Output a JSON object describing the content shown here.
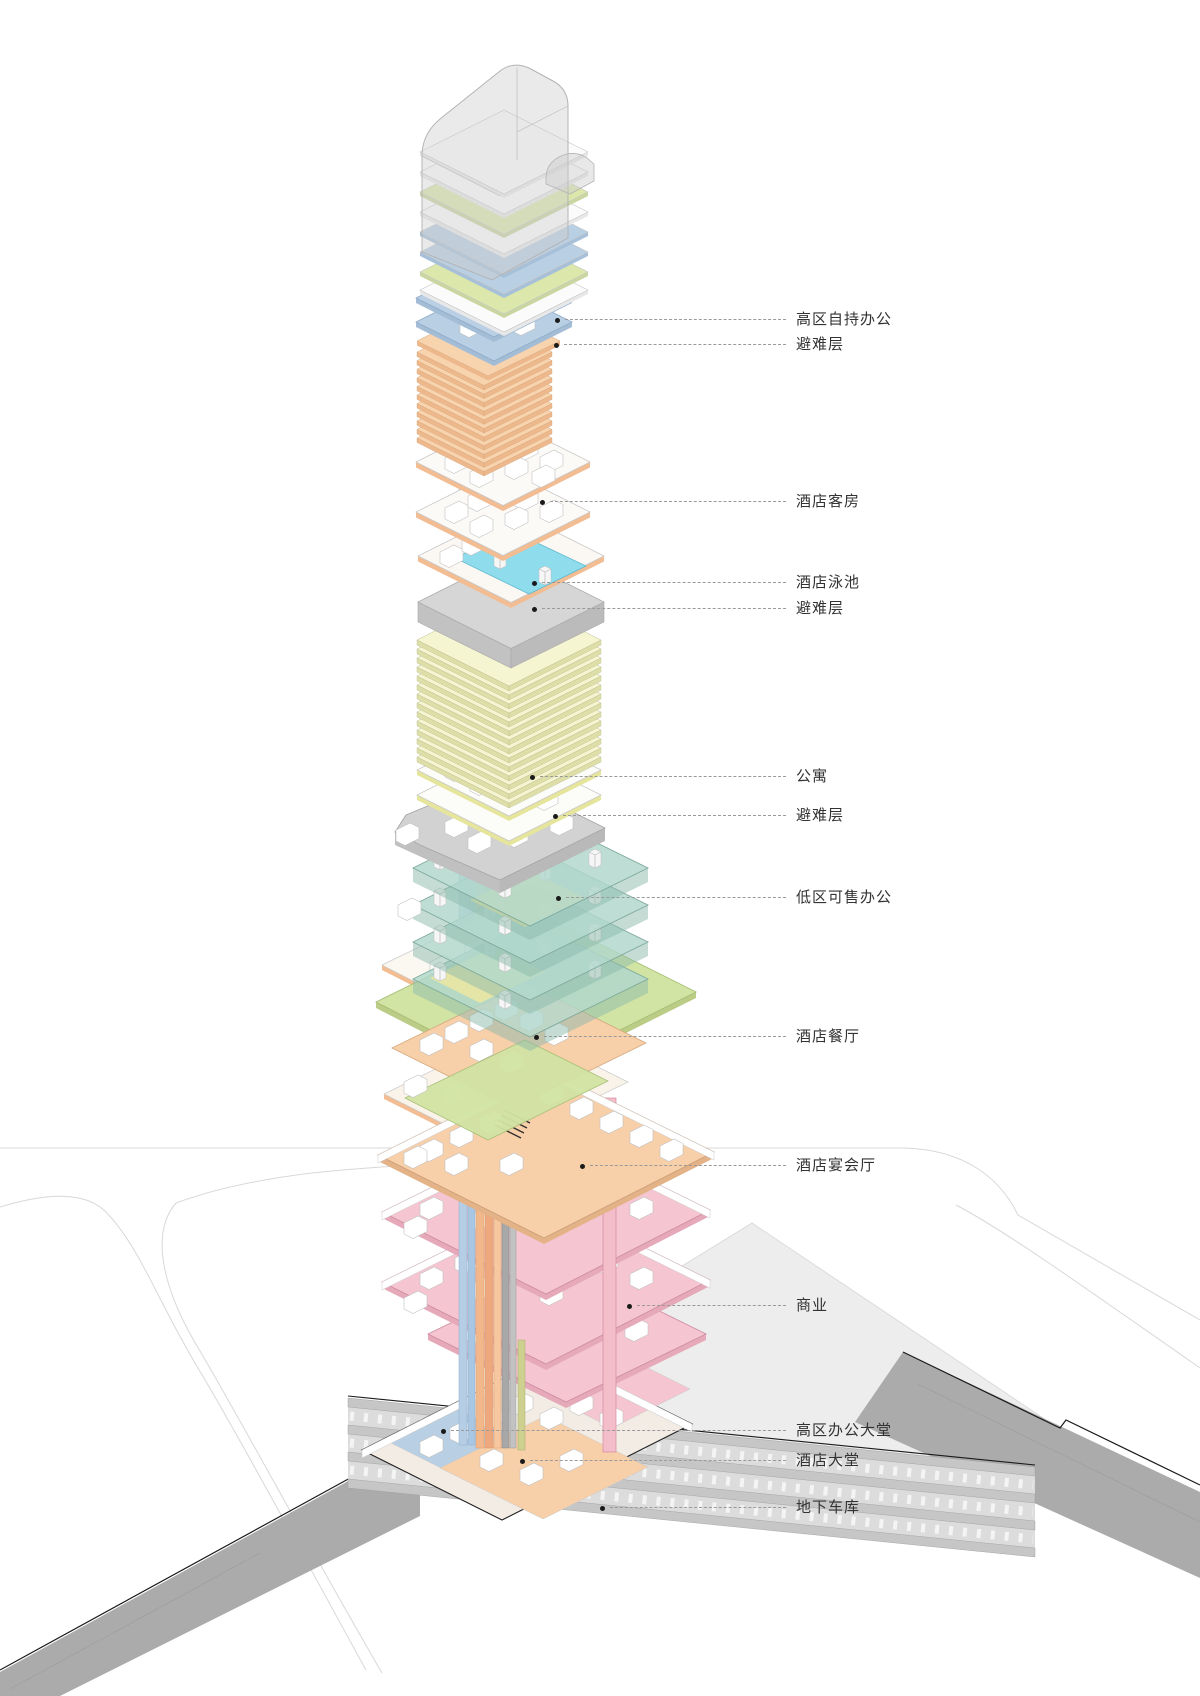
{
  "figure": {
    "type": "exploded-axonometric-building-program-diagram",
    "language": "zh-CN",
    "description": "Vertical program stacking diagram of a supertall mixed-use tower with underground garage"
  },
  "labels": [
    {
      "text": "高区自持办公"
    },
    {
      "text": "避难层"
    },
    {
      "text": "酒店客房"
    },
    {
      "text": "酒店泳池"
    },
    {
      "text": "避难层"
    },
    {
      "text": "公寓"
    },
    {
      "text": "避难层"
    },
    {
      "text": "低区可售办公"
    },
    {
      "text": "酒店餐厅"
    },
    {
      "text": "酒店宴会厅"
    },
    {
      "text": "商业"
    },
    {
      "text": "高区办公大堂"
    },
    {
      "text": "酒店大堂"
    },
    {
      "text": "地下车库"
    }
  ],
  "program_colors": {
    "office_high_zone": "#b9cfe4",
    "hotel": "#f7cfa9",
    "apartment": "#f5f5d2",
    "office_low_zone": "#b4d8cd",
    "restaurant": "#d2e4a4",
    "retail": "#f5c6d1",
    "refuge": "#d0d0d0",
    "pool_water": "#8fdcec",
    "parking": "#c4c4c4",
    "leader_line": "#9a9a9a",
    "label_text": "#333333"
  }
}
